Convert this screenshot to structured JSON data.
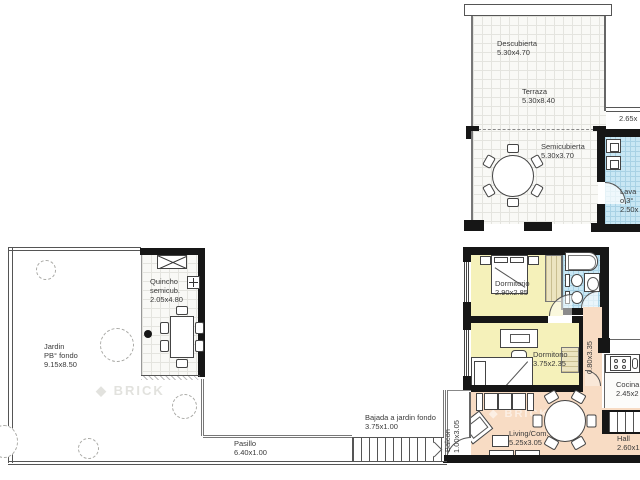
{
  "watermark": {
    "icon": "◆",
    "text": "BRICK"
  },
  "rooms": {
    "descubierta": {
      "name": "Descubierta",
      "dim": "5.30x4.70"
    },
    "terraza": {
      "name": "Terraza",
      "dim": "5.30x8.40"
    },
    "semicubierta": {
      "name": "Semicubierta",
      "dim": "5.30x3.70"
    },
    "terraza_side_dim": "2.65x",
    "lavadero": {
      "line1": "Lava",
      "line2": "o 3°",
      "line3": "2.50x"
    },
    "dormitorio1": {
      "name": "Dormitorio",
      "dim": "2.90x2.85"
    },
    "dormitorio2": {
      "name": "Dormitorio",
      "dim": "3.75x2.35"
    },
    "pasillo_interior": {
      "dim": "0.80x3.35"
    },
    "cocina": {
      "name": "Cocina",
      "dim": "2.45x2"
    },
    "hall": {
      "name": "Hall",
      "dim": "2.60x1"
    },
    "living": {
      "name": "Living/Com.",
      "dim": "5.25x3.05"
    },
    "balcon": {
      "name": "Balcon",
      "dim": "1.00x3.05"
    },
    "pasillo": {
      "name": "Pasillo",
      "dim": "6.40x1.00"
    },
    "bajada": {
      "name": "Bajada a jardin fondo",
      "dim": "3.75x1.00"
    },
    "jardin": {
      "name": "Jardin",
      "line2": "PB° fondo",
      "dim": "9.15x8.50"
    },
    "quincho": {
      "name": "Quincho",
      "line2": "semicub.",
      "dim": "2.05x4.80"
    }
  },
  "colors": {
    "bedroom": "#f5f1ba",
    "wet": "#c9e7f4",
    "social": "#f8dcc4",
    "wall": "#161616"
  }
}
